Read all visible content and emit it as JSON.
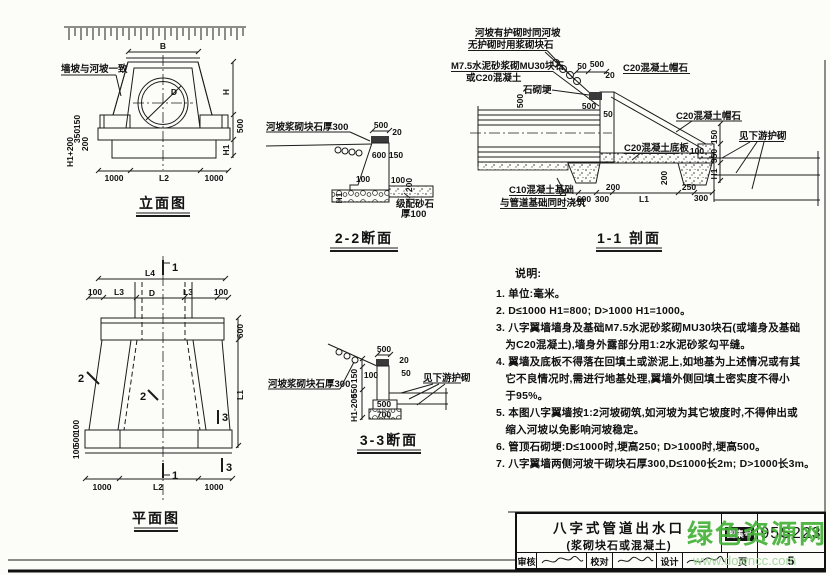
{
  "sheet": {
    "watermark": {
      "name": "绿色资源网",
      "url": "www.downcc.com",
      "color": "#44b238",
      "url_color": "#a5d69e"
    }
  },
  "title_block": {
    "title_line1": "八字式管道出水口",
    "title_line2": "(浆砌块石或混凝土)",
    "fields": {
      "atlas_label": "图集号",
      "atlas_no": "95S223",
      "page_label": "页",
      "page": "5",
      "review": "审核",
      "proof": "校对",
      "design": "设计"
    }
  },
  "notes": {
    "heading": "说明:",
    "lines": [
      "1. 单位:毫米。",
      "2. D≤1000 H1=800; D>1000 H1=1000。",
      "3. 八字翼墙墙身及基础M7.5水泥砂浆砌MU30块石(或墙身及基础",
      "   为C20混凝土),墙身外露部分用1:2水泥砂浆勾平缝。",
      "4. 翼墙及底板不得落在回填土或淤泥上,如地基为上述情况或有其",
      "   它不良情况时,需进行地基处理,翼墙外侧回填土密实度不得小",
      "   于95%。",
      "5. 本图八字翼墙按1:2河坡砌筑,如河坡为其它坡度时,不得伸出或",
      "   缩入河坡以免影响河坡稳定。",
      "6. 管顶石砌埂:D≤1000时,埂高250; D>1000时,埂高500。",
      "7. 八字翼墙两侧河坡干砌块石厚300,D≤1000长2m; D>1000长3m。"
    ]
  },
  "views": {
    "elevation": {
      "title": "立面图",
      "slope_note": "墙坡与河坡一致",
      "dims": {
        "top": "B",
        "h": "H",
        "cap": "500",
        "h1": "H1",
        "pipe": "D",
        "left": [
          "150",
          "350",
          "200",
          "H1+200"
        ],
        "bottom": [
          "1000",
          "L2",
          "1000"
        ]
      }
    },
    "s22": {
      "title": "2-2断面",
      "slope_label": "河坡浆砌块石厚300",
      "gravel_label_1": "级配砂石",
      "gravel_label_2": "厚100",
      "dims": {
        "cap_w": "500",
        "cap_o": "20",
        "w600": "600",
        "w150": "150",
        "toe_l": "100",
        "toe_r": "100",
        "bed": "200",
        "h1": "H1"
      }
    },
    "s11": {
      "title": "1-1 剖面",
      "labels": {
        "slope1": "河坡有护砌时同河坡",
        "slope2": "无护砌时用浆砌块石",
        "mortar1": "M7.5水泥砂浆砌MU30块石",
        "mortar2": "或C20混凝土",
        "ridge": "石砌埂",
        "cap_top": "C20混凝土帽石",
        "cap_mid": "C20混凝土帽石",
        "downstream": "见下游护砌",
        "slab": "C20混凝土底板",
        "footing1": "C10混凝土基础",
        "footing2": "与管道基础同时浇筑"
      },
      "dims": {
        "d50": "50",
        "d500a": "500",
        "d20": "20",
        "d500b": "500",
        "d500c": "500",
        "d50b": "50",
        "v150": "150",
        "v350": "350",
        "vh1": "H1",
        "d100": "100",
        "d250": "250",
        "d300a": "300",
        "v200": "200",
        "d200": "200",
        "d600": "600",
        "d300b": "300",
        "dl1": "L1"
      }
    },
    "plan": {
      "title": "平面图",
      "dims": {
        "l4": "L4",
        "row": [
          "100",
          "L3",
          "D",
          "L3",
          "100"
        ],
        "r600": "600",
        "rl1": "L1",
        "left": [
          "100",
          "500",
          "100"
        ],
        "bottom": [
          "1000",
          "L2",
          "1000"
        ]
      },
      "markers": {
        "m1": "1",
        "m2": "2",
        "m3": "3"
      }
    },
    "s33": {
      "title": "3-3断面",
      "slope_label": "河坡浆砌块石厚300",
      "downstream": "见下游护砌",
      "dims": {
        "cap_w": "500",
        "cap_o": "20",
        "d100": "100",
        "d50": "50",
        "v150": "150",
        "v550": "550",
        "vh1": "H1-200",
        "f500": "500",
        "f700": "700"
      }
    }
  }
}
